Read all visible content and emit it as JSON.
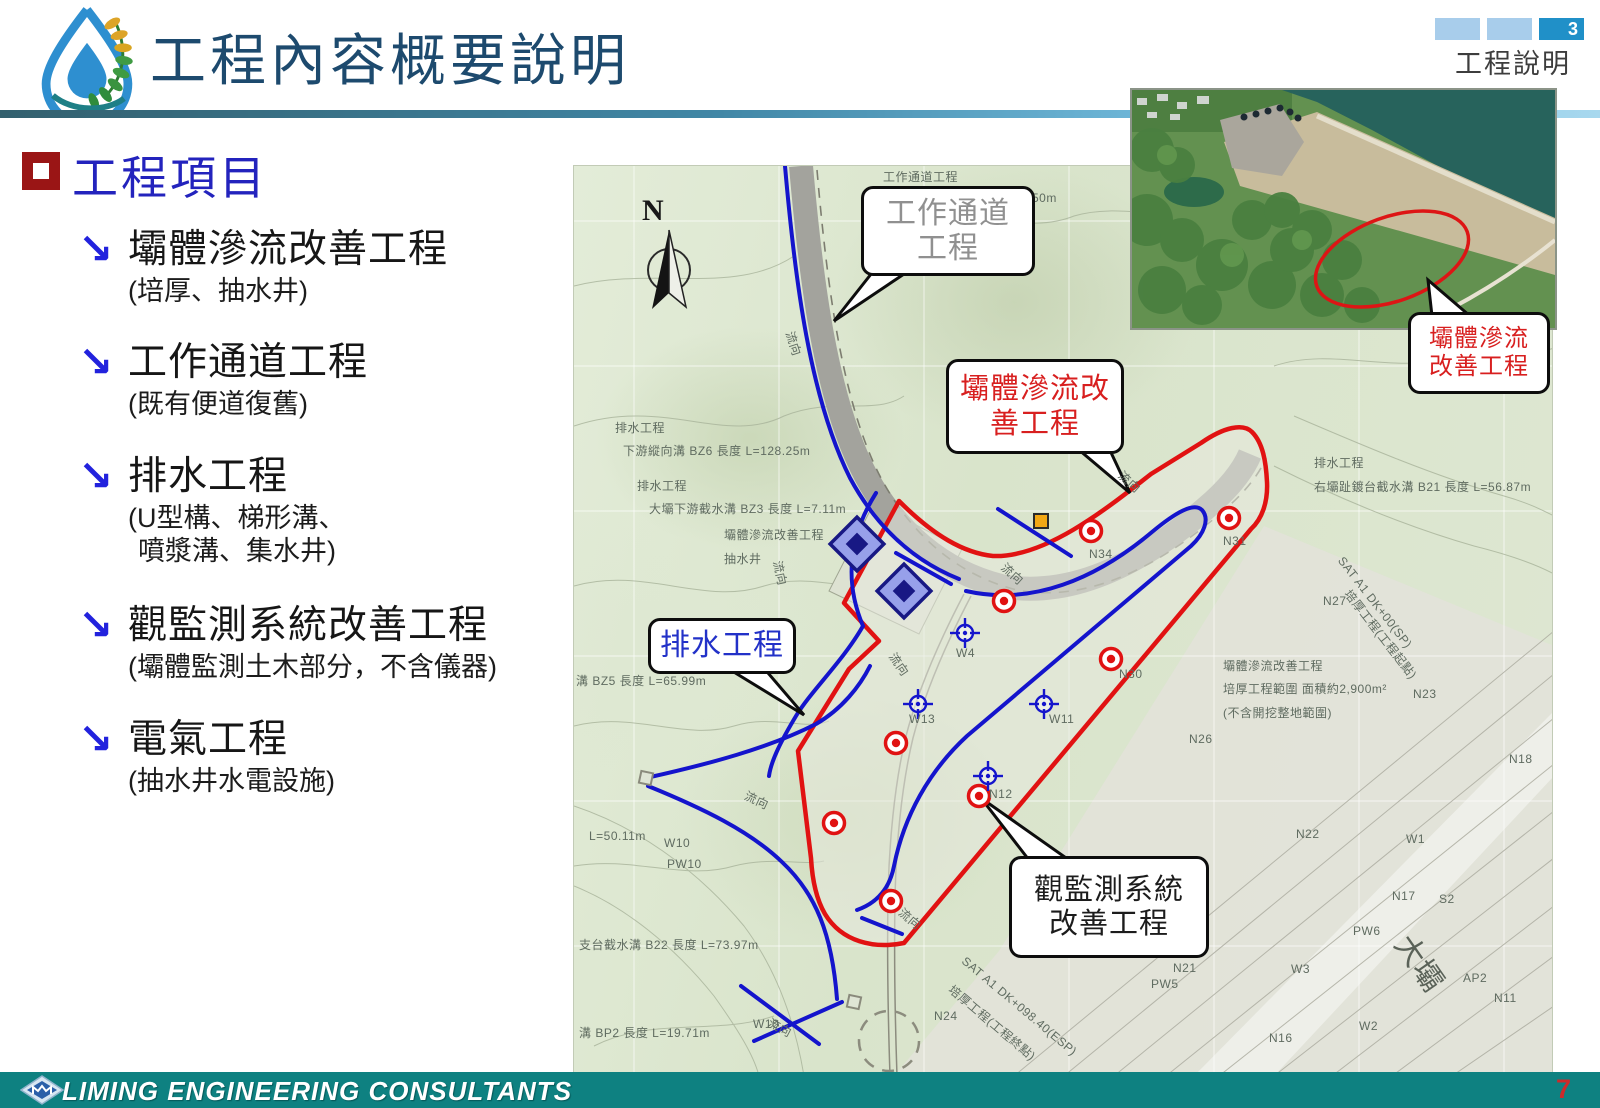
{
  "header": {
    "title": "工程內容概要說明",
    "tab_page_number": "3",
    "tab_label": "工程說明"
  },
  "content": {
    "heading": "工程項目",
    "items": [
      {
        "title": "壩體滲流改善工程",
        "subtitle": "(培厚、抽水井)"
      },
      {
        "title": "工作通道工程",
        "subtitle": "(既有便道復舊)"
      },
      {
        "title": "排水工程",
        "subtitle": "(U型構、梯形溝、",
        "subtitle2": "噴漿溝、集水井)"
      },
      {
        "title": "觀監測系統改善工程",
        "subtitle": "(壩體監測土木部分，不含儀器)"
      },
      {
        "title": "電氣工程",
        "subtitle": "(抽水井水電設施)"
      }
    ]
  },
  "map": {
    "north_label": "N",
    "callouts": {
      "work_road": {
        "line1": "工作通道",
        "line2": "工程"
      },
      "seepage": {
        "line1": "壩體滲流改",
        "line2": "善工程"
      },
      "drainage": {
        "line1": "排水工程"
      },
      "monitoring": {
        "line1": "觀監測系統",
        "line2": "改善工程"
      }
    },
    "labels": [
      {
        "t": "排水工程",
        "x": 41,
        "y": 253
      },
      {
        "t": "下游縱向溝 BZ6 長度 L=128.25m",
        "x": 49,
        "y": 276
      },
      {
        "t": "排水工程",
        "x": 63,
        "y": 311
      },
      {
        "t": "大壩下游截水溝 BZ3 長度 L=7.11m",
        "x": 75,
        "y": 334
      },
      {
        "t": "壩體滲流改善工程",
        "x": 150,
        "y": 360
      },
      {
        "t": "抽水井",
        "x": 150,
        "y": 384
      },
      {
        "t": "溝 BZ5 長度 L=65.99m",
        "x": 2,
        "y": 506
      },
      {
        "t": "L=50.11m",
        "x": 15,
        "y": 663
      },
      {
        "t": "W10",
        "x": 90,
        "y": 670
      },
      {
        "t": "PW10",
        "x": 93,
        "y": 691
      },
      {
        "t": "支台截水溝 B22 長度 L=73.97m",
        "x": 5,
        "y": 770
      },
      {
        "t": "溝 BP2 長度 L=19.71m",
        "x": 5,
        "y": 858
      },
      {
        "t": "W10",
        "x": 179,
        "y": 851
      },
      {
        "t": "排水工程",
        "x": 740,
        "y": 288
      },
      {
        "t": "右壩趾鍍台截水溝 B21 長度 L=56.87m",
        "x": 740,
        "y": 312
      },
      {
        "t": "SAT A1 DK+00(SP)",
        "x": 772,
        "y": 388,
        "r": 52
      },
      {
        "t": "培厚工程(工程起點)",
        "x": 780,
        "y": 420,
        "r": 52
      },
      {
        "t": "N27",
        "x": 749,
        "y": 428
      },
      {
        "t": "壩體滲流改善工程",
        "x": 649,
        "y": 491
      },
      {
        "t": "培厚工程範圍 面積約2,900m²",
        "x": 649,
        "y": 514
      },
      {
        "t": "(不含開挖整地範圍)",
        "x": 649,
        "y": 538
      },
      {
        "t": "N23",
        "x": 839,
        "y": 521
      },
      {
        "t": "N26",
        "x": 615,
        "y": 566
      },
      {
        "t": "N18",
        "x": 935,
        "y": 586
      },
      {
        "t": "N22",
        "x": 722,
        "y": 661
      },
      {
        "t": "W1",
        "x": 832,
        "y": 666
      },
      {
        "t": "N17",
        "x": 818,
        "y": 723
      },
      {
        "t": "S2",
        "x": 865,
        "y": 726
      },
      {
        "t": "PW6",
        "x": 779,
        "y": 758
      },
      {
        "t": "W3",
        "x": 717,
        "y": 796
      },
      {
        "t": "大壩",
        "x": 848,
        "y": 758,
        "r": 55,
        "s": 30,
        "c": "#5a6258"
      },
      {
        "t": "AP2",
        "x": 889,
        "y": 805
      },
      {
        "t": "N11",
        "x": 920,
        "y": 825
      },
      {
        "t": "W2",
        "x": 785,
        "y": 853
      },
      {
        "t": "N16",
        "x": 695,
        "y": 865
      },
      {
        "t": "N24",
        "x": 360,
        "y": 843
      },
      {
        "t": "N21",
        "x": 599,
        "y": 795
      },
      {
        "t": "PW5",
        "x": 577,
        "y": 811
      },
      {
        "t": "N34",
        "x": 515,
        "y": 381
      },
      {
        "t": "N31",
        "x": 649,
        "y": 368
      },
      {
        "t": "N30",
        "x": 545,
        "y": 501
      },
      {
        "t": "W4",
        "x": 382,
        "y": 480
      },
      {
        "t": "W13",
        "x": 335,
        "y": 546
      },
      {
        "t": "W11",
        "x": 475,
        "y": 546
      },
      {
        "t": "N12",
        "x": 415,
        "y": 621
      },
      {
        "t": "2.50m",
        "x": 447,
        "y": 25
      },
      {
        "t": "工作通道工程",
        "x": 309,
        "y": 2
      },
      {
        "t": "SAT A1 DK+098.40(ESP)",
        "x": 394,
        "y": 788,
        "r": 40
      },
      {
        "t": "培厚工程(工程終點)",
        "x": 382,
        "y": 815,
        "r": 40
      },
      {
        "t": "流向",
        "x": 224,
        "y": 163,
        "r": 72
      },
      {
        "t": "流向",
        "x": 212,
        "y": 393,
        "r": 78
      },
      {
        "t": "流向",
        "x": 325,
        "y": 483,
        "r": 55
      },
      {
        "t": "流向",
        "x": 435,
        "y": 393,
        "r": 42
      },
      {
        "t": "流向",
        "x": 552,
        "y": 301,
        "r": 42
      },
      {
        "t": "流向",
        "x": 175,
        "y": 621,
        "r": 25
      },
      {
        "t": "流向",
        "x": 199,
        "y": 848,
        "r": 28
      },
      {
        "t": "流向",
        "x": 332,
        "y": 738,
        "r": 40
      }
    ],
    "symbols": {
      "red_targets": [
        [
          517,
          365
        ],
        [
          655,
          352
        ],
        [
          430,
          435
        ],
        [
          537,
          493
        ],
        [
          322,
          577
        ],
        [
          260,
          657
        ],
        [
          405,
          630
        ],
        [
          317,
          735
        ]
      ],
      "crosshairs": [
        [
          391,
          467
        ],
        [
          344,
          538
        ],
        [
          470,
          538
        ],
        [
          414,
          610
        ]
      ],
      "pump_wells": [
        [
          283,
          378
        ],
        [
          330,
          425
        ]
      ],
      "orange_squares": [
        [
          467,
          355
        ]
      ],
      "end_squares": [
        [
          72,
          612
        ],
        [
          280,
          836
        ]
      ]
    }
  },
  "photo": {
    "callout": {
      "line1": "壩體滲流",
      "line2": "改善工程"
    }
  },
  "footer": {
    "company": "LIMING ENGINEERING CONSULTANTS",
    "page_number": "7"
  },
  "colors": {
    "accent_teal": "#0e8181",
    "title_navy": "#1d4a6e",
    "heading_blue": "#2323bd",
    "bullet_maroon": "#9a1515",
    "map_red": "#e11212",
    "map_blue": "#1414cc",
    "tab_active": "#2090c8",
    "tab_inactive": "#a8cdeb"
  }
}
